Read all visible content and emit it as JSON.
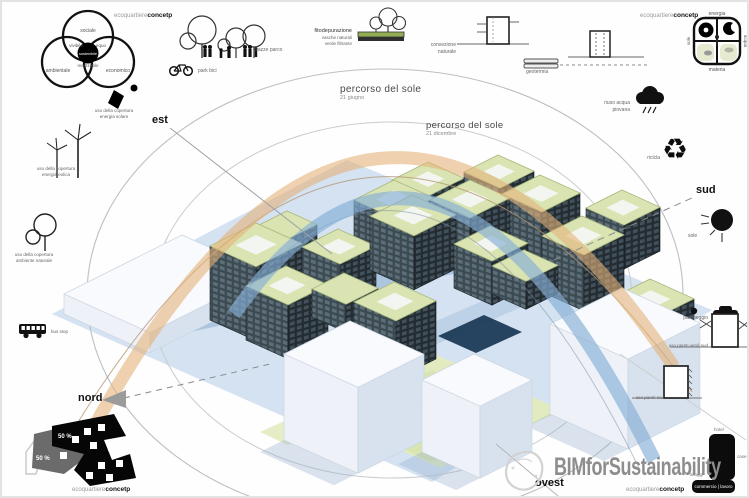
{
  "watermark": {
    "text": "BIMforSustainability"
  },
  "brand": {
    "regular": "ecoquartiere",
    "bold": "concetp"
  },
  "compass": {
    "est": "est",
    "sud": "sud",
    "nord": "nord",
    "ovest": "ovest"
  },
  "sun_path": {
    "summer_label": "percorso del sole",
    "summer_date": "21 giugno",
    "winter_label": "percorso del sole",
    "winter_date": "21 dicembre"
  },
  "venn": {
    "top": "sociale",
    "left": "ambientale",
    "right": "economico",
    "top_left": "vivibile",
    "top_right": "equo",
    "center": "sostenibile",
    "bottom_center": "realizzabile"
  },
  "legend_left": {
    "solar_line1": "uso della copertura",
    "solar_line2": "energia solare",
    "wind_line1": "uso della copertura",
    "wind_line2": "energia eolica",
    "nature_line1": "uso della copertura",
    "nature_line2": "ambiente naturale",
    "bus": "bus stop"
  },
  "legend_top": {
    "park": "piazze parco",
    "bike": "park bici",
    "phyto_title": "fitodepurazione",
    "phyto_line1": "vasche naturali",
    "phyto_line2": "verde filtrante",
    "convection": "convezione naturale",
    "geothermal": "geotermia"
  },
  "legend_right": {
    "rain": "riuso acqua piovana",
    "recycle": "ricicla",
    "sun": "sole",
    "parking": "parcheggio",
    "green_walls": "uso pareti verdi sud",
    "south_walls": "uso pareti sud",
    "zone_hotel": "hotel",
    "zone_case": "case",
    "zone_alloggi": "alloggi",
    "zone_bar": "commercio | lavoro"
  },
  "matrix": {
    "top": "energia",
    "bottom": "materia",
    "left": "sole",
    "right": "acqua"
  },
  "site_plan": {
    "value1": "50 %",
    "value2": "50 %"
  },
  "icons": {
    "recycle": "♻"
  },
  "colors": {
    "summer_arc": "#e4b27a",
    "winter_arc": "#86aed6",
    "roof_green": "#d9e4b2",
    "ground_blue": "#d4e2f1",
    "facade_dark": "#3c4a52"
  }
}
